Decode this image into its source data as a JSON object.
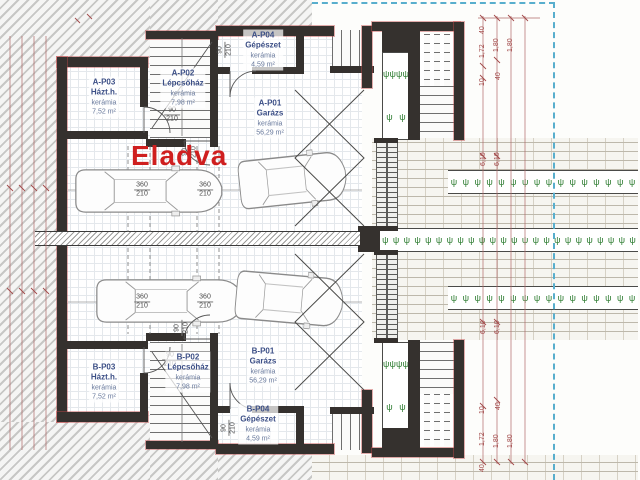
{
  "plan": {
    "sold_stamp": "Eladva",
    "rooms": {
      "a_p03": {
        "id": "A-P03",
        "name": "Házt.h.",
        "material": "kerámia",
        "area": "7,52 m²"
      },
      "a_p02": {
        "id": "A-P02",
        "name": "Lépcsőház",
        "material": "kerámia",
        "area": "7,98 m²"
      },
      "a_p04": {
        "id": "A-P04",
        "name": "Gépészet",
        "material": "kerámia",
        "area": "4,59 m²"
      },
      "a_p01": {
        "id": "A-P01",
        "name": "Garázs",
        "material": "kerámia",
        "area": "56,29 m²"
      },
      "b_p03": {
        "id": "B-P03",
        "name": "Házt.h.",
        "material": "kerámia",
        "area": "7,52 m²"
      },
      "b_p02": {
        "id": "B-P02",
        "name": "Lépcsőház",
        "material": "kerámia",
        "area": "7,98 m²"
      },
      "b_p01": {
        "id": "B-P01",
        "name": "Garázs",
        "material": "kerámia",
        "area": "56,29 m²"
      },
      "b_p04": {
        "id": "B-P04",
        "name": "Gépészet",
        "material": "kerámia",
        "area": "4,59 m²"
      }
    },
    "dims": {
      "door": {
        "w": "90",
        "h": "210"
      },
      "garage": {
        "w": "360",
        "h": "210"
      },
      "right_top": [
        "40",
        "1,72",
        "1,80",
        "1,80",
        "10",
        "40"
      ],
      "right_bottom": [
        "10",
        "40",
        "1,72",
        "1,80",
        "1,80",
        "40"
      ],
      "drive_top": [
        "6,10",
        "6,10"
      ],
      "drive_bottom": [
        "6,10",
        "6,10"
      ]
    },
    "legend": {
      "plant_glyph": "ψ"
    },
    "colors": {
      "sold_red": "#cf1f1f",
      "dimension_red": "#a24a4a",
      "wall_dark": "#35312e",
      "label_navy": "#3c4f86",
      "boundary_blue": "#58aecd",
      "plant_green": "#2f7d32"
    }
  }
}
